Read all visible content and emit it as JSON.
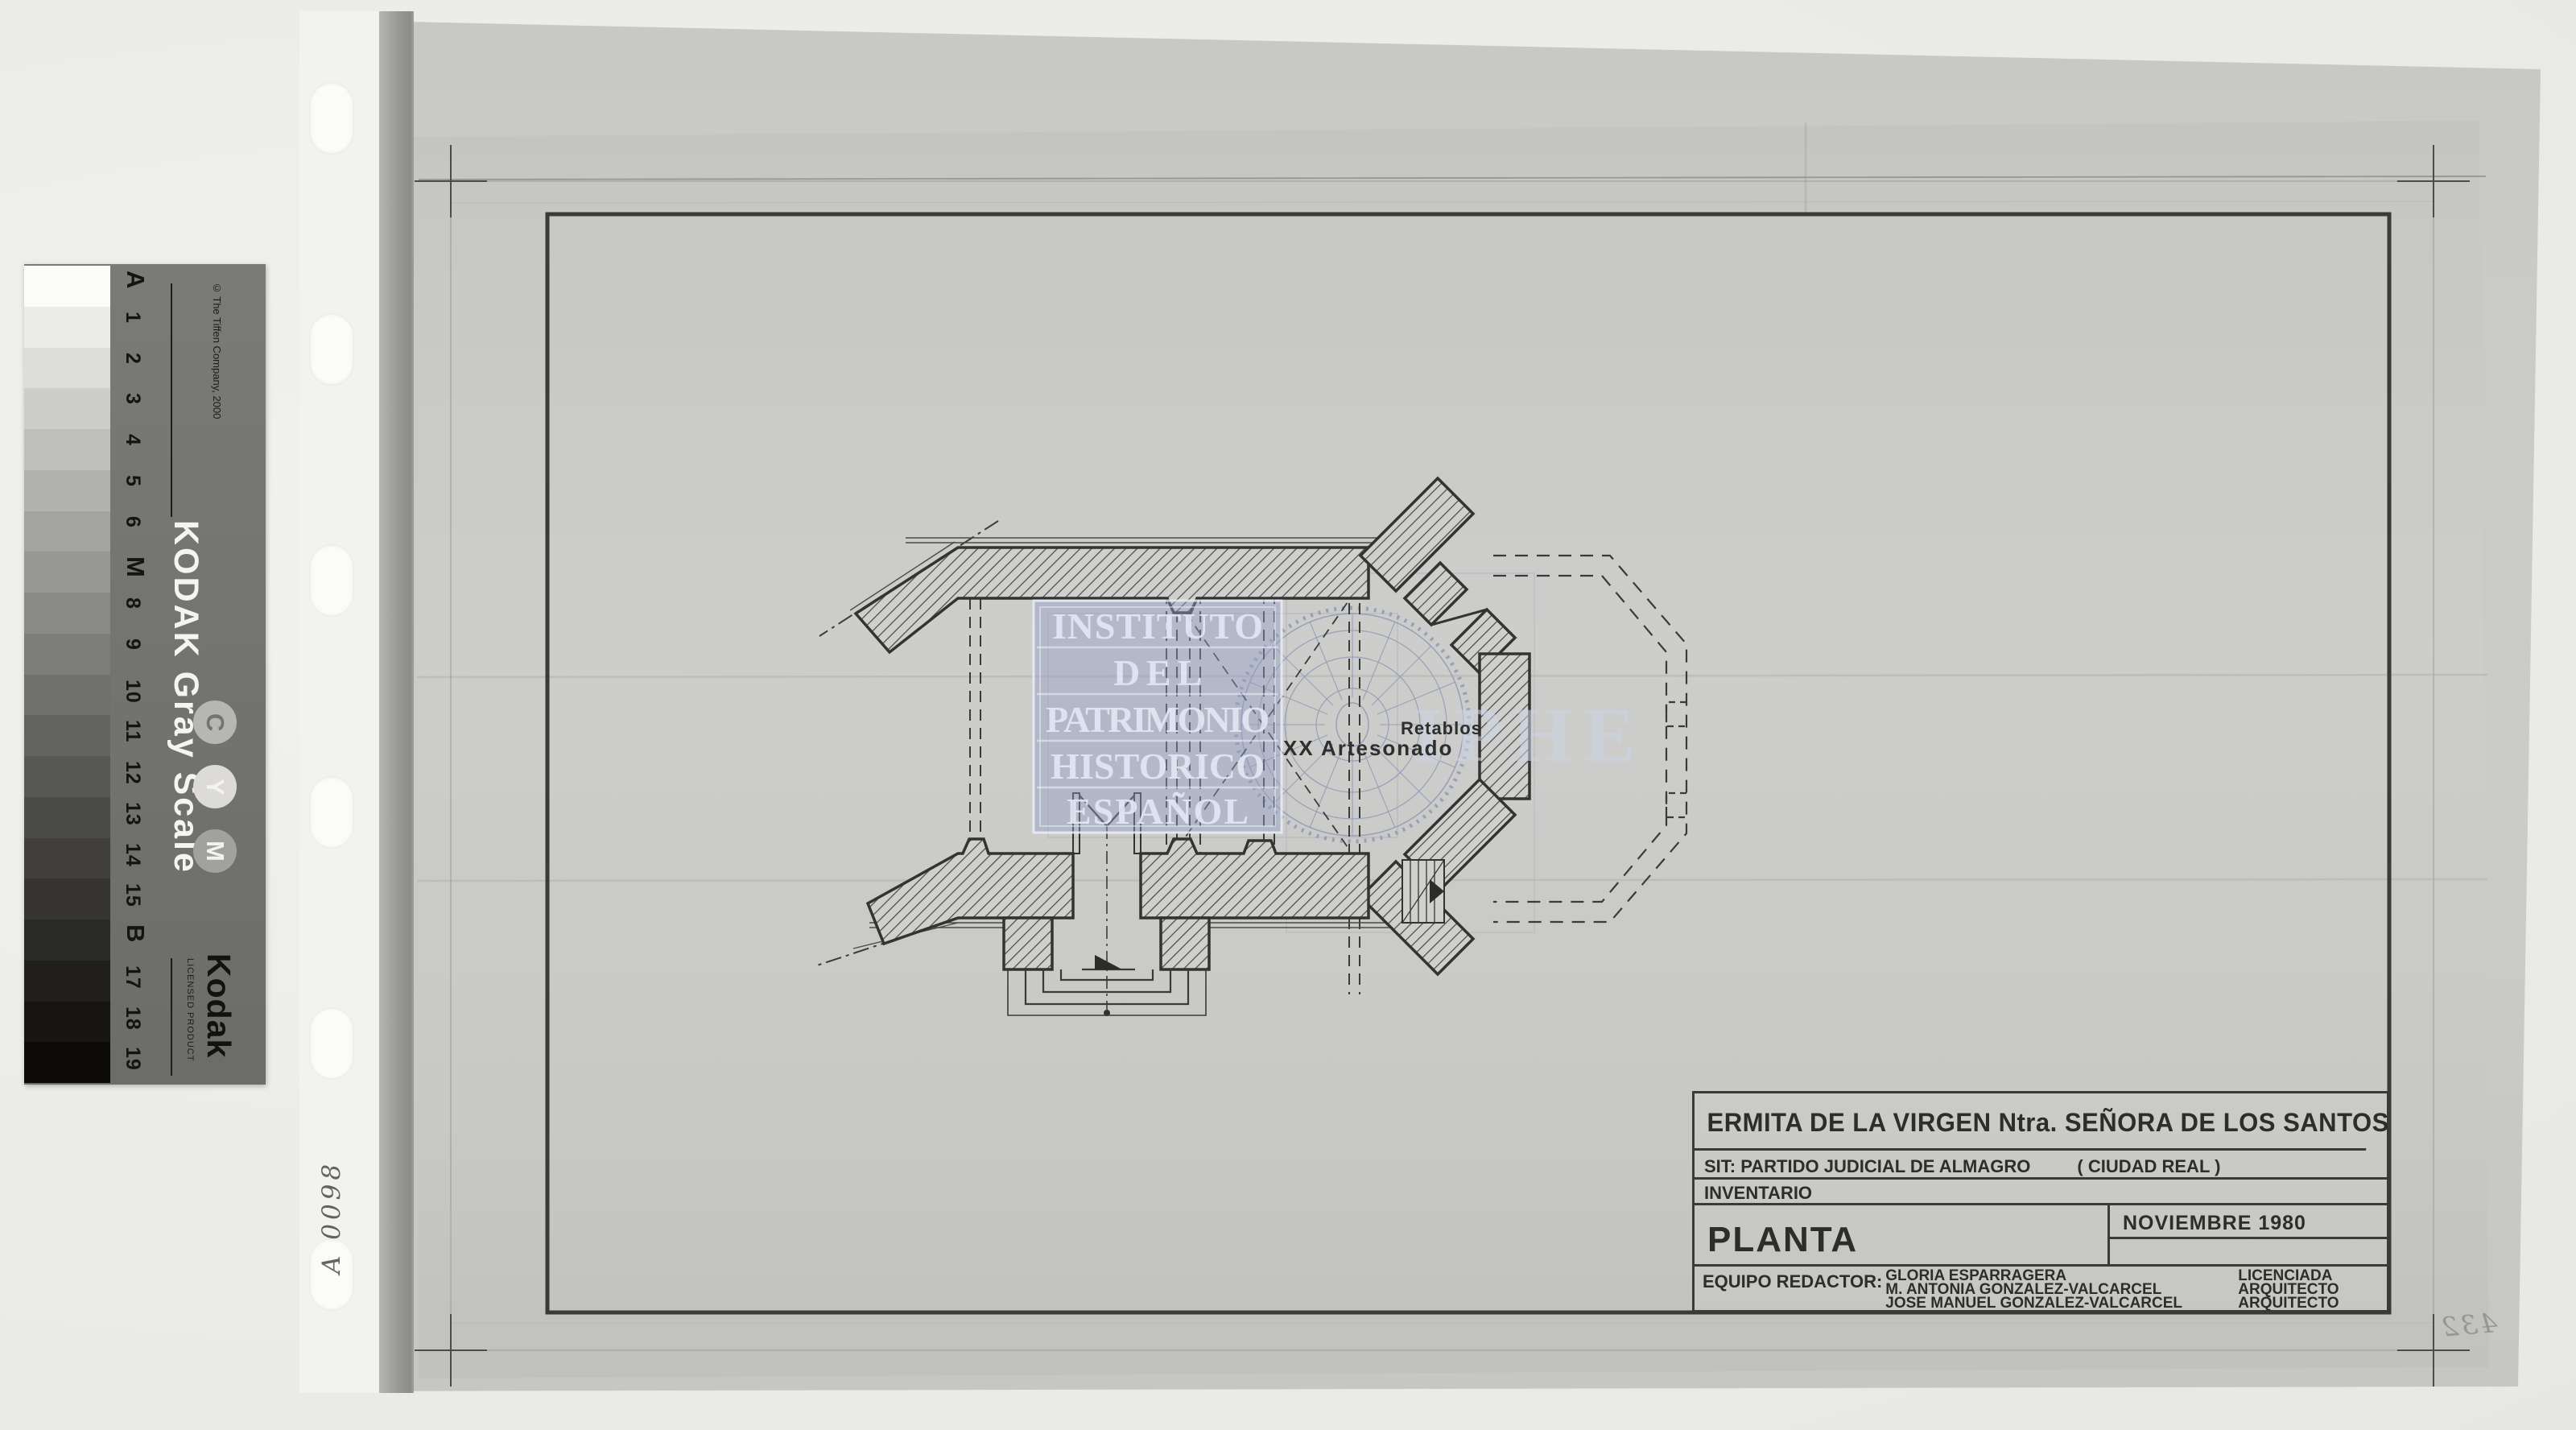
{
  "kodak_strip": {
    "name": "KODAK Gray Scale",
    "copyright": "© The Tiffen Company, 2000",
    "labels": [
      "A",
      "1",
      "2",
      "3",
      "4",
      "5",
      "6",
      "M",
      "8",
      "9",
      "10",
      "11",
      "12",
      "13",
      "14",
      "15",
      "B",
      "17",
      "18",
      "19"
    ],
    "patch_grays": [
      "#fbfbf9",
      "#ebebe9",
      "#dcdcda",
      "#cdcdcb",
      "#bfbfbd",
      "#b1b1af",
      "#a3a3a1",
      "#969694",
      "#898987",
      "#7c7c7a",
      "#6f6f6d",
      "#636361",
      "#575755",
      "#4b4b49",
      "#403f3e",
      "#353432",
      "#2a2a28",
      "#201f1e",
      "#161514",
      "#0c0b0a"
    ],
    "cym_letters": [
      "C",
      "Y",
      "M"
    ],
    "logo": "Kodak",
    "licensed": "LICENSED PRODUCT"
  },
  "annotations": {
    "archive_number": "A 0098",
    "corner_number": "432"
  },
  "watermark": {
    "institute_lines": [
      "INSTITUTO",
      "DEL",
      "PATRIMONIO",
      "HISTORICO",
      "ESPAÑOL"
    ],
    "acronym": "IPHE",
    "stamp_blue": "#95a0c6"
  },
  "plan_labels": {
    "ceiling": "XX  Artesonado",
    "altarpieces": "Retablos"
  },
  "title_block": {
    "title": "ERMITA DE LA VIRGEN  Ntra. SEÑORA DE LOS SANTOS",
    "location_label": "SIT: PARTIDO JUDICIAL DE ALMAGRO",
    "location_paren": "( CIUDAD REAL )",
    "inventory_label": "INVENTARIO",
    "drawing_name": "PLANTA",
    "date": "NOVIEMBRE  1980",
    "team_label": "EQUIPO REDACTOR:",
    "team": [
      {
        "name": "GLORIA ESPARRAGERA",
        "role": "LICENCIADA"
      },
      {
        "name": "M. ANTONIA GONZALEZ-VALCARCEL",
        "role": "ARQUITECTO"
      },
      {
        "name": "JOSE MANUEL GONZALEZ-VALCARCEL",
        "role": "ARQUITECTO"
      }
    ]
  }
}
